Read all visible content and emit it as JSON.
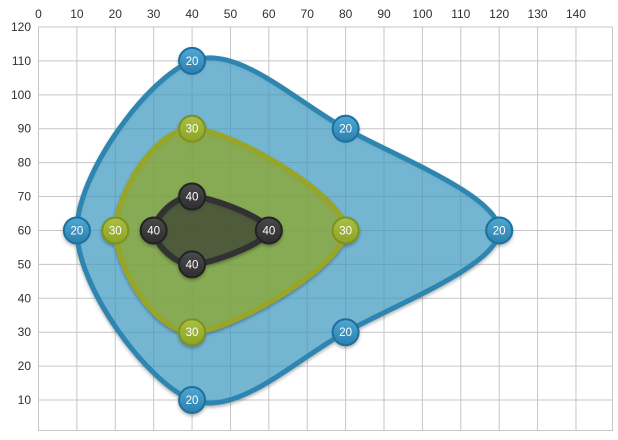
{
  "chart": {
    "background": "#ffffff",
    "grid_color": "#c6c6c6",
    "tick_color": "#303030"
  },
  "chart_data": {
    "type": "contour",
    "title": "",
    "subtitle": "",
    "grid": true,
    "legend": "none",
    "x_axis": {
      "position": "top",
      "min": 0,
      "max": 150,
      "step": 10,
      "ticks": [
        0,
        10,
        20,
        30,
        40,
        50,
        60,
        70,
        80,
        90,
        100,
        110,
        120,
        130,
        140
      ]
    },
    "y_axis": {
      "position": "left",
      "min": 0,
      "max": 120,
      "step": 10,
      "ticks": [
        120,
        110,
        100,
        90,
        80,
        70,
        60,
        50,
        40,
        30,
        20,
        10
      ]
    },
    "series": [
      {
        "level": "20",
        "points": [
          [
            40,
            110
          ],
          [
            80,
            90
          ],
          [
            120,
            60
          ],
          [
            80,
            30
          ],
          [
            40,
            10
          ],
          [
            10,
            60
          ]
        ],
        "line_color": "#2e86b0",
        "line_width": 5,
        "fill_color": "rgba(61,158,201,0.64)",
        "marker_top": "#4fa8d2",
        "marker_bottom": "#2c7fae",
        "marker_ring": "#1f6f9e"
      },
      {
        "level": "30",
        "points": [
          [
            40,
            90
          ],
          [
            80,
            60
          ],
          [
            40,
            30
          ],
          [
            20,
            60
          ]
        ],
        "line_color": "#98a527",
        "line_width": 5,
        "fill_color": "rgba(152,174,30,0.62)",
        "marker_top": "#aabf45",
        "marker_bottom": "#8da426",
        "marker_ring": "#7d921e"
      },
      {
        "level": "40",
        "points": [
          [
            40,
            70
          ],
          [
            60,
            60
          ],
          [
            40,
            50
          ],
          [
            30,
            60
          ]
        ],
        "line_color": "#333333",
        "line_width": 6,
        "fill_color": "rgba(45,45,45,0.55)",
        "marker_top": "#4a4a4a",
        "marker_bottom": "#2e2e2e",
        "marker_ring": "#232323"
      }
    ]
  }
}
